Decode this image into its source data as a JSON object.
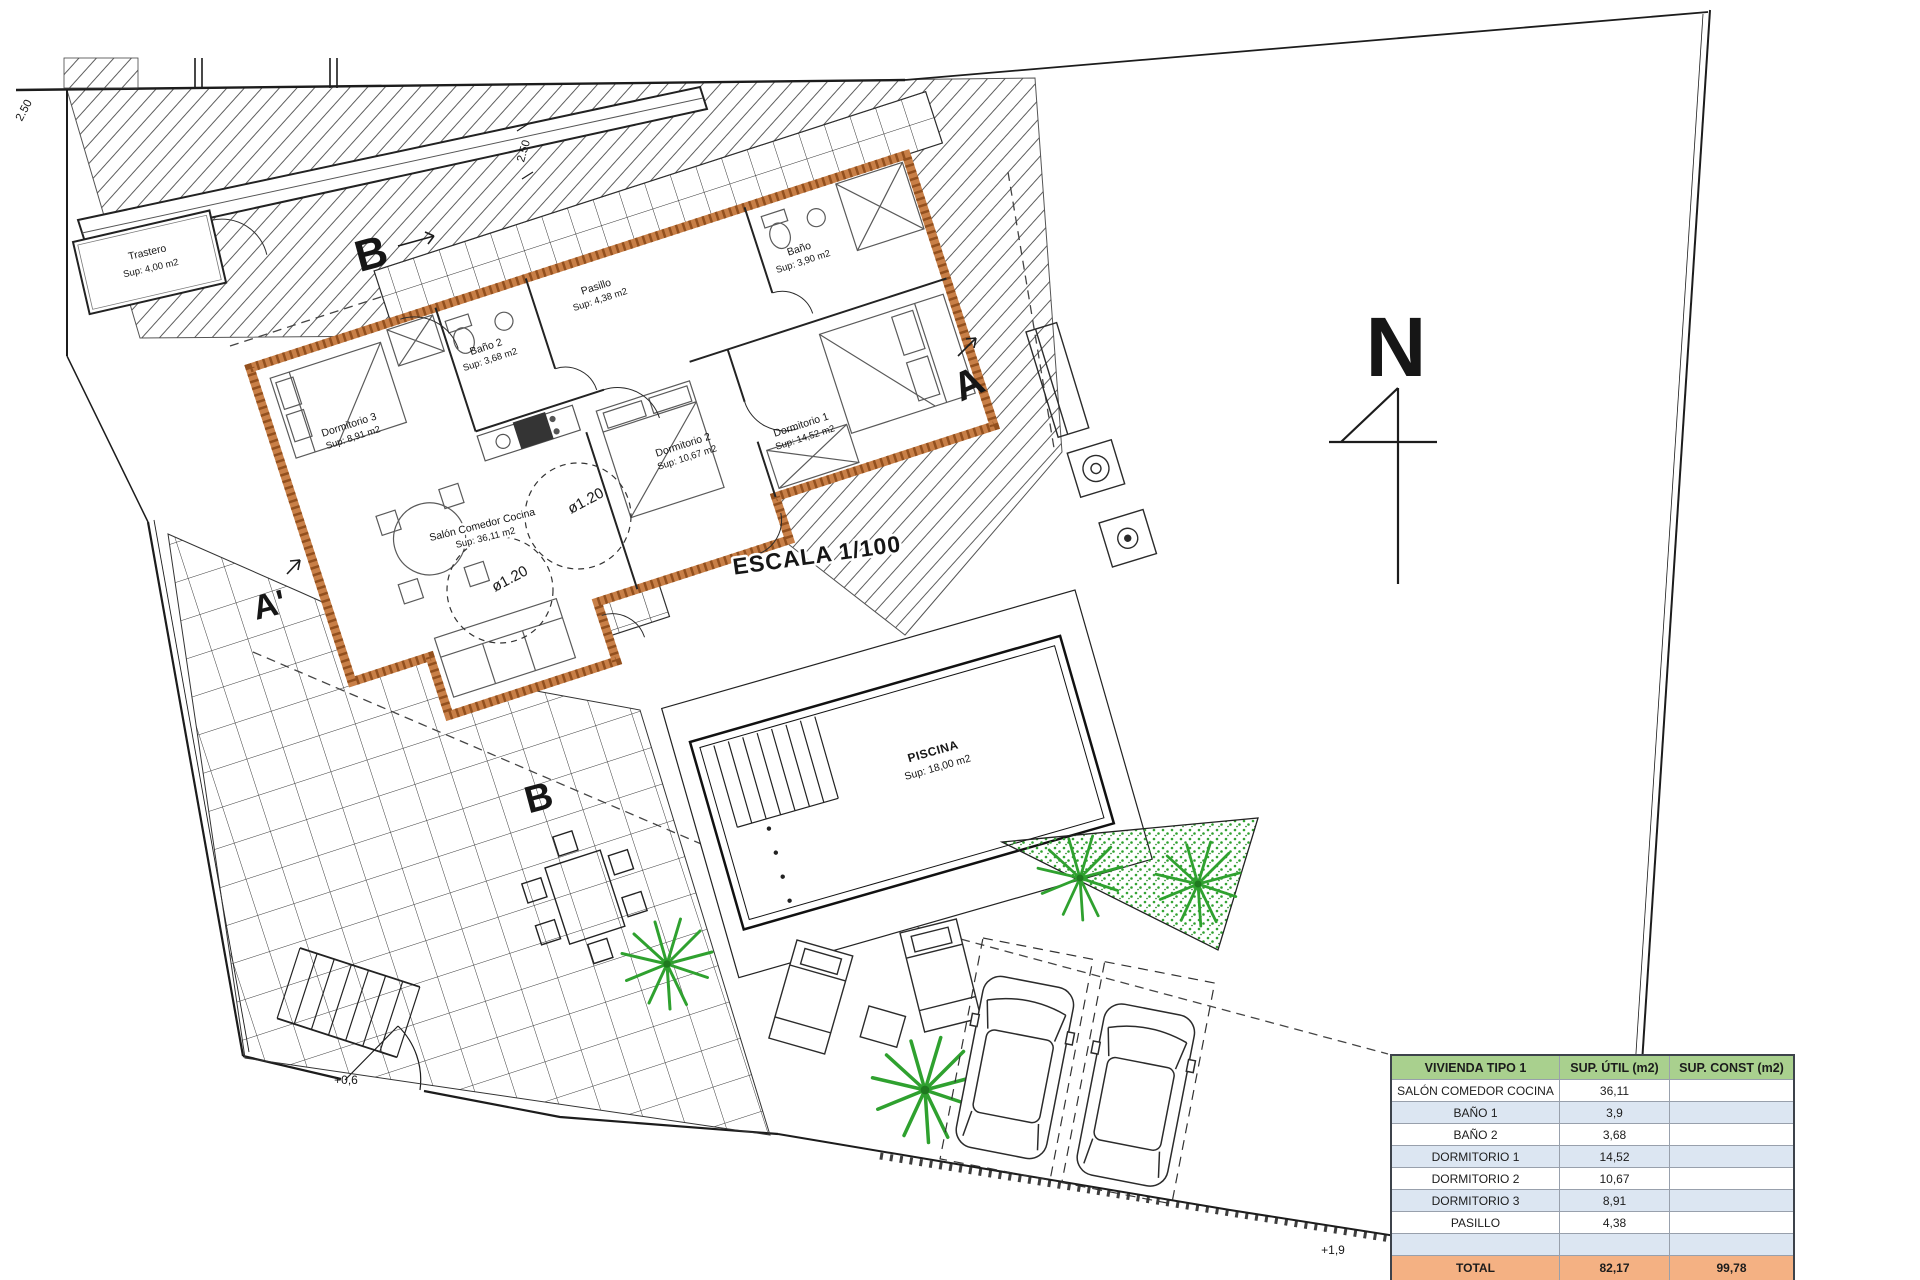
{
  "plan": {
    "north_label": "N",
    "scale_label": "ESCALA 1/100",
    "rooms": [
      {
        "name": "Trastero",
        "area": "Sup: 4,00 m2"
      },
      {
        "name": "Pasillo",
        "area": "Sup: 4,38 m2"
      },
      {
        "name": "Baño",
        "area": "Sup: 3,90 m2"
      },
      {
        "name": "Baño 2",
        "area": "Sup: 3,68 m2"
      },
      {
        "name": "Dormitorio 3",
        "area": "Sup: 8,91 m2"
      },
      {
        "name": "Dormitorio 2",
        "area": "Sup: 10,67 m2"
      },
      {
        "name": "Dormitorio 1",
        "area": "Sup: 14,52 m2"
      },
      {
        "name": "Salón Comedor Cocina",
        "area": "Sup: 36,11 m2"
      },
      {
        "name": "PISCINA",
        "area": "Sup: 18,00 m2"
      }
    ],
    "markers": {
      "section_b_top": "B",
      "section_b_bottom": "B",
      "section_a": "A",
      "section_a_prime": "A'"
    },
    "dimensions": {
      "top_right": "2.50",
      "top_left": "2.50"
    },
    "levels": {
      "gate": "+0,6",
      "corner": "+1,9"
    },
    "accessibility_circles": {
      "circle_1": "ø1.20",
      "circle_2": "ø1.20"
    }
  },
  "area_table": {
    "headers": [
      "VIVIENDA TIPO 1",
      "SUP. ÚTIL (m2)",
      "SUP. CONST (m2)"
    ],
    "rows": [
      {
        "label": "SALÓN COMEDOR COCINA",
        "util": "36,11",
        "const": ""
      },
      {
        "label": "BAÑO 1",
        "util": "3,9",
        "const": ""
      },
      {
        "label": "BAÑO 2",
        "util": "3,68",
        "const": ""
      },
      {
        "label": "DORMITORIO 1",
        "util": "14,52",
        "const": ""
      },
      {
        "label": "DORMITORIO 2",
        "util": "10,67",
        "const": ""
      },
      {
        "label": "DORMITORIO 3",
        "util": "8,91",
        "const": ""
      },
      {
        "label": "PASILLO",
        "util": "4,38",
        "const": ""
      },
      {
        "label": "",
        "util": "",
        "const": ""
      }
    ],
    "total": {
      "label": "TOTAL",
      "util": "82,17",
      "const": "99,78"
    },
    "colors": {
      "header_bg": "#A9D08E",
      "alt_row_bg": "#DCE6F2",
      "total_bg": "#F4B183",
      "wall_orange": "#C87F47",
      "vegetation_green": "#2FA12F"
    }
  }
}
